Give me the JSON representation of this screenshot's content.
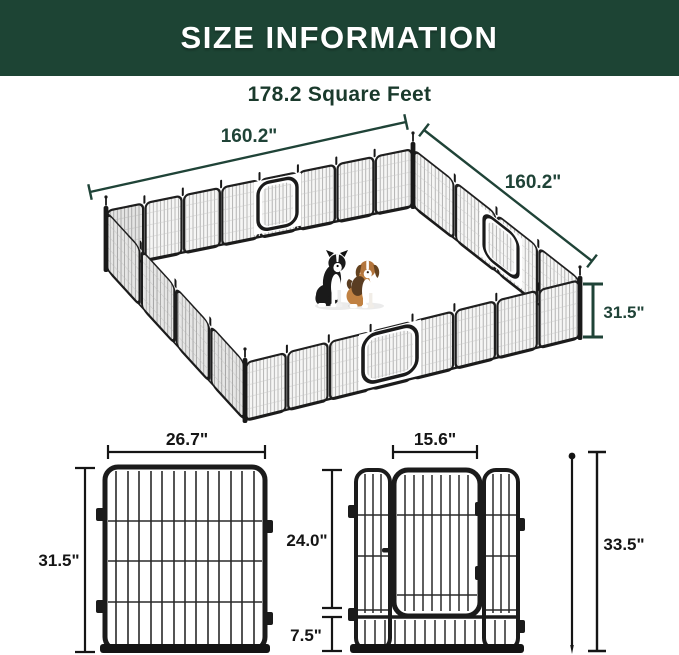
{
  "header": {
    "title": "SIZE INFORMATION",
    "bg_color": "#1d4434"
  },
  "pen": {
    "area_label": "178.2 Square Feet",
    "side_a_label": "160.2\"",
    "side_b_label": "160.2\"",
    "height_label": "31.5\"",
    "illustrations": [
      "border-collie-dog",
      "beagle-dog"
    ]
  },
  "panel_diagram": {
    "width_label": "26.7\"",
    "height_label": "31.5\""
  },
  "door_diagram": {
    "door_width_label": "15.6\"",
    "door_height_label": "24.0\"",
    "bottom_label": "7.5\""
  },
  "stake_diagram": {
    "height_label": "33.5\""
  },
  "colors": {
    "dimension_green": "#1f4337",
    "ink": "#151515",
    "fence_dark": "#1b1b1b"
  }
}
